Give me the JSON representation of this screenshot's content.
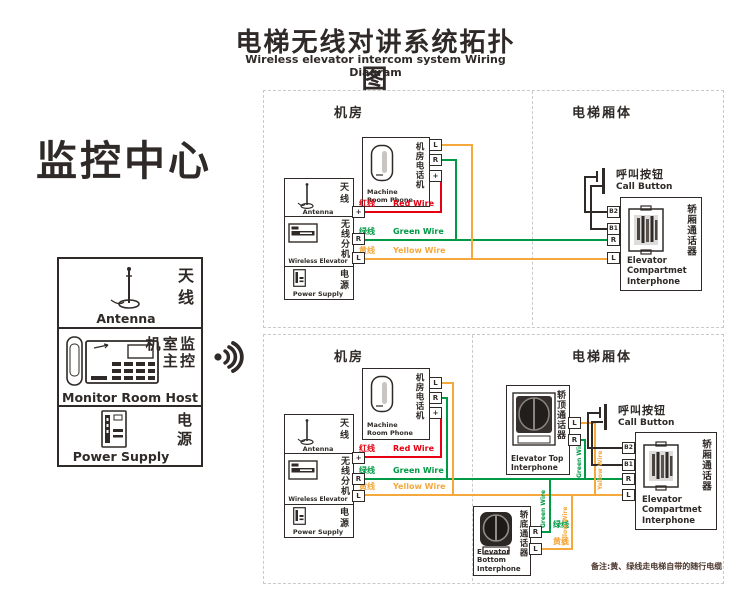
{
  "header": {
    "title_zh": "电梯无线对讲系统拓扑图",
    "title_en": "Wireless elevator intercom system Wiring Diagram"
  },
  "monitor_center": {
    "title": "监控中心",
    "antenna": {
      "zh": "天线",
      "en": "Antenna"
    },
    "host": {
      "zh": "监控室主机",
      "en": "Monitor Room Host"
    },
    "power": {
      "zh": "电源",
      "en": "Power Supply"
    }
  },
  "regions": {
    "machine_room": "机房",
    "elevator_car": "电梯厢体"
  },
  "unit": {
    "antenna": {
      "zh": "天线",
      "en": "Antenna"
    },
    "wireless": {
      "zh": "无线分机",
      "en": "Wireless Elevator"
    },
    "power": {
      "zh": "电源",
      "en": "Power Supply"
    },
    "terminals": {
      "plus": "+",
      "r": "R",
      "l": "L"
    }
  },
  "phone": {
    "zh": "机房电话机",
    "en_line1": "Machine",
    "en_line2": "Room Phone",
    "terminals": {
      "l": "L",
      "r": "R",
      "plus": "+"
    }
  },
  "wires": {
    "red": {
      "zh": "红线",
      "en": "Red Wire",
      "color": "#e60012"
    },
    "green": {
      "zh": "绿线",
      "en": "Green Wire",
      "color": "#009a44"
    },
    "yellow": {
      "zh": "黄线",
      "en": "Yellow Wire",
      "color": "#f5a83c"
    }
  },
  "call_button": {
    "zh": "呼叫按钮",
    "en": "Call Button"
  },
  "compartment": {
    "zh": "轿厢通话器",
    "en_line1": "Elevator",
    "en_line2": "Compartmet",
    "en_line3": "Interphone",
    "terminals": {
      "b2": "B2",
      "b1": "B1",
      "r": "R",
      "l": "L"
    }
  },
  "top_interphone": {
    "zh": "轿顶通话器",
    "en_line1": "Elevator Top",
    "en_line2": "Interphone",
    "terminals": {
      "l": "L",
      "r": "R"
    }
  },
  "bottom_interphone": {
    "zh": "轿底通话器",
    "en_line1": "Elevator Bottom",
    "en_line2": "Interphone",
    "terminals": {
      "r": "R",
      "l": "L"
    }
  },
  "note": "备注:黄、绿线走电梯自带的随行电缆"
}
